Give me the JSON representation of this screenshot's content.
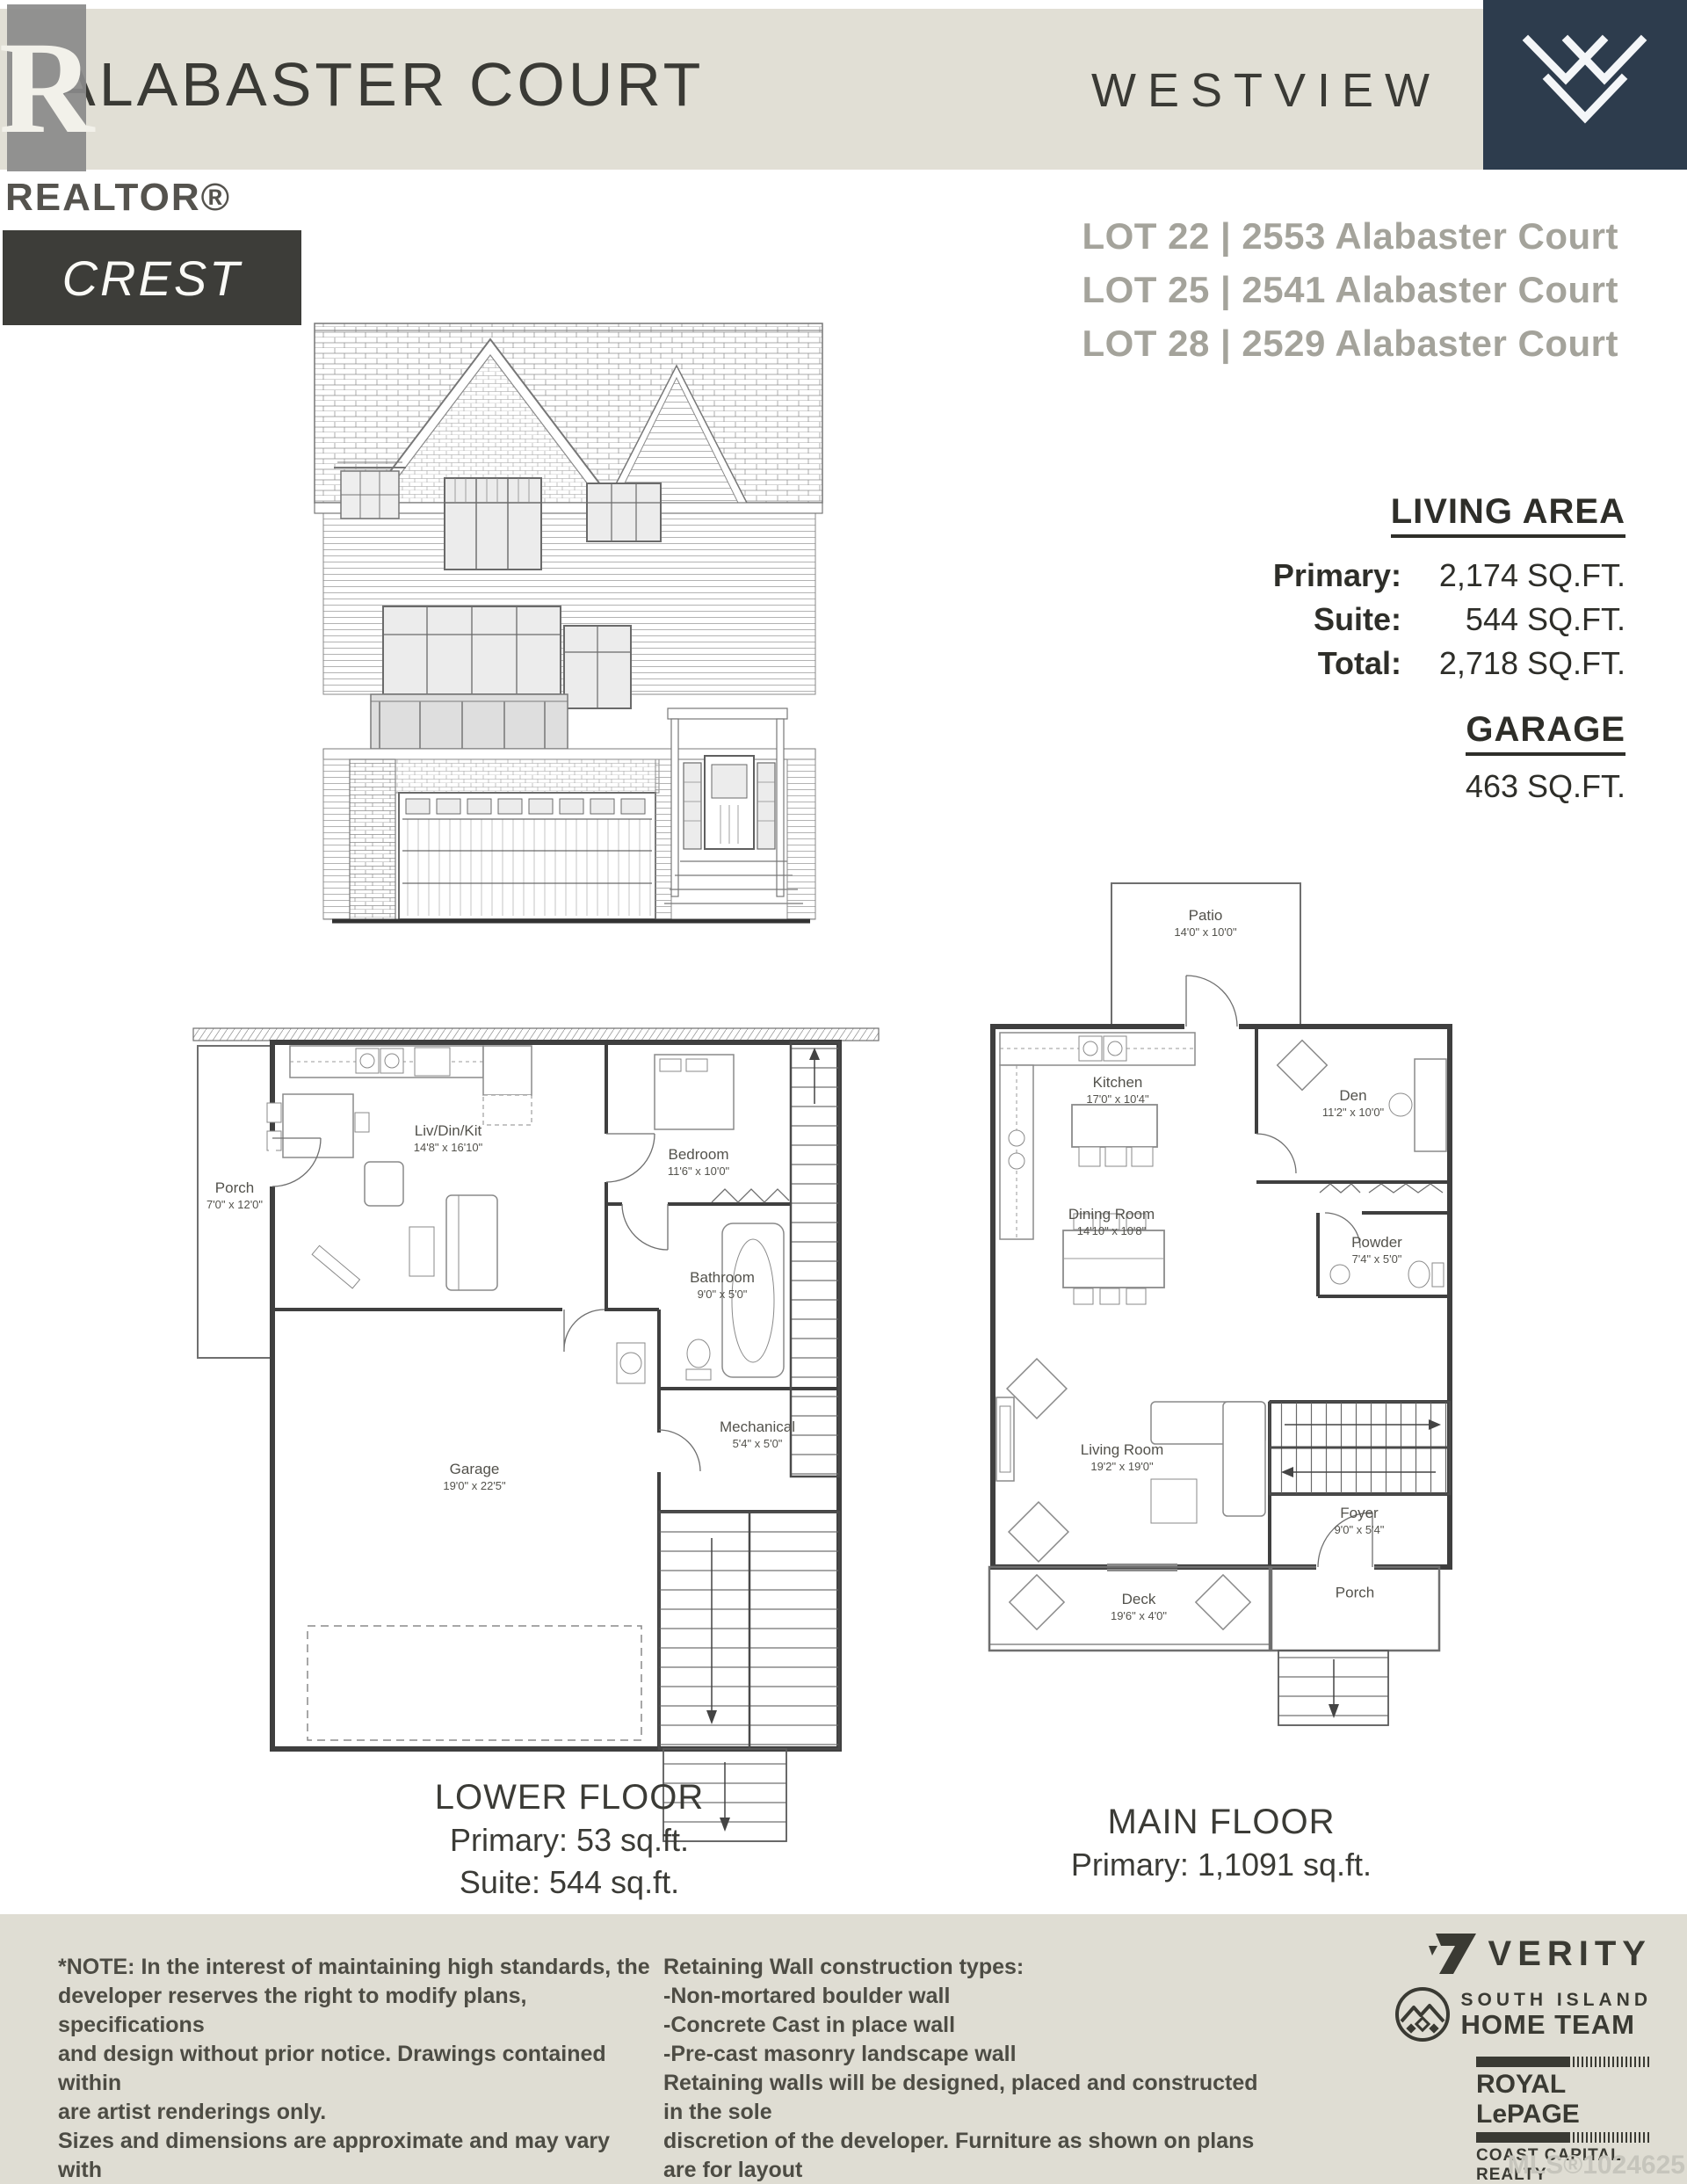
{
  "header": {
    "title": "ALABASTER COURT",
    "brand": "WESTVIEW",
    "model": "CREST",
    "realtor_r": "R",
    "realtor_label": "REALTOR®"
  },
  "lots": {
    "line1": "LOT 22 | 2553 Alabaster Court",
    "line2": "LOT 25 | 2541 Alabaster Court",
    "line3": "LOT 28 | 2529 Alabaster Court"
  },
  "living_area": {
    "heading": "LIVING AREA",
    "rows": [
      {
        "label": "Primary:",
        "value": "2,174 SQ.FT."
      },
      {
        "label": "Suite:",
        "value": "544 SQ.FT."
      },
      {
        "label": "Total:",
        "value": "2,718 SQ.FT."
      }
    ]
  },
  "garage": {
    "heading": "GARAGE",
    "value": "463 SQ.FT."
  },
  "lower_floor": {
    "title": "LOWER FLOOR",
    "stat1": "Primary: 53 sq.ft.",
    "stat2": "Suite: 544 sq.ft.",
    "rooms": {
      "porch": {
        "name": "Porch",
        "dims": "7'0\" x 12'0\""
      },
      "livdinkit": {
        "name": "Liv/Din/Kit",
        "dims": "14'8\" x 16'10\""
      },
      "bedroom": {
        "name": "Bedroom",
        "dims": "11'6\" x 10'0\""
      },
      "bathroom": {
        "name": "Bathroom",
        "dims": "9'0\" x 5'0\""
      },
      "garage": {
        "name": "Garage",
        "dims": "19'0\" x 22'5\""
      },
      "mechanical": {
        "name": "Mechanical",
        "dims": "5'4\" x 5'0\""
      }
    }
  },
  "main_floor": {
    "title": "MAIN FLOOR",
    "stat1": "Primary: 1,1091 sq.ft.",
    "rooms": {
      "patio": {
        "name": "Patio",
        "dims": "14'0\" x 10'0\""
      },
      "kitchen": {
        "name": "Kitchen",
        "dims": "17'0\" x 10'4\""
      },
      "den": {
        "name": "Den",
        "dims": "11'2\" x 10'0\""
      },
      "dining": {
        "name": "Dining Room",
        "dims": "14'10\" x 10'8\""
      },
      "powder": {
        "name": "Powder",
        "dims": "7'4\" x 5'0\""
      },
      "living": {
        "name": "Living Room",
        "dims": "19'2\" x 19'0\""
      },
      "foyer": {
        "name": "Foyer",
        "dims": "9'0\" x 5'4\""
      },
      "deck": {
        "name": "Deck",
        "dims": "19'6\" x 4'0\""
      },
      "porch": {
        "name": "Porch",
        "dims": ""
      }
    }
  },
  "footer": {
    "note": "*NOTE: In the interest of maintaining high standards, the\ndeveloper reserves the right to modify plans, specifications\nand design without prior notice. Drawings contained within\nare artist renderings only.\nSizes and dimensions are approximate and may vary with\nactual plan and survey. Exterior style may change pending\nmunicipal approval.",
    "retaining": "Retaining Wall construction types:\n-Non-mortared boulder wall\n-Concrete Cast in place wall\n-Pre-cast masonry landscape wall\nRetaining walls will be designed, placed and constructed in the sole\ndiscretion of the developer. Furniture as shown on plans are for layout\npurposes only and are not included in the sale",
    "logos": {
      "verity": "VERITY",
      "team_line1": "SOUTH ISLAND",
      "team_line2": "HOME TEAM",
      "brokerage": "ROYAL LePAGE",
      "brokerage_sub": "COAST CAPITAL REALTY",
      "mls": "MLS®1024625"
    }
  }
}
